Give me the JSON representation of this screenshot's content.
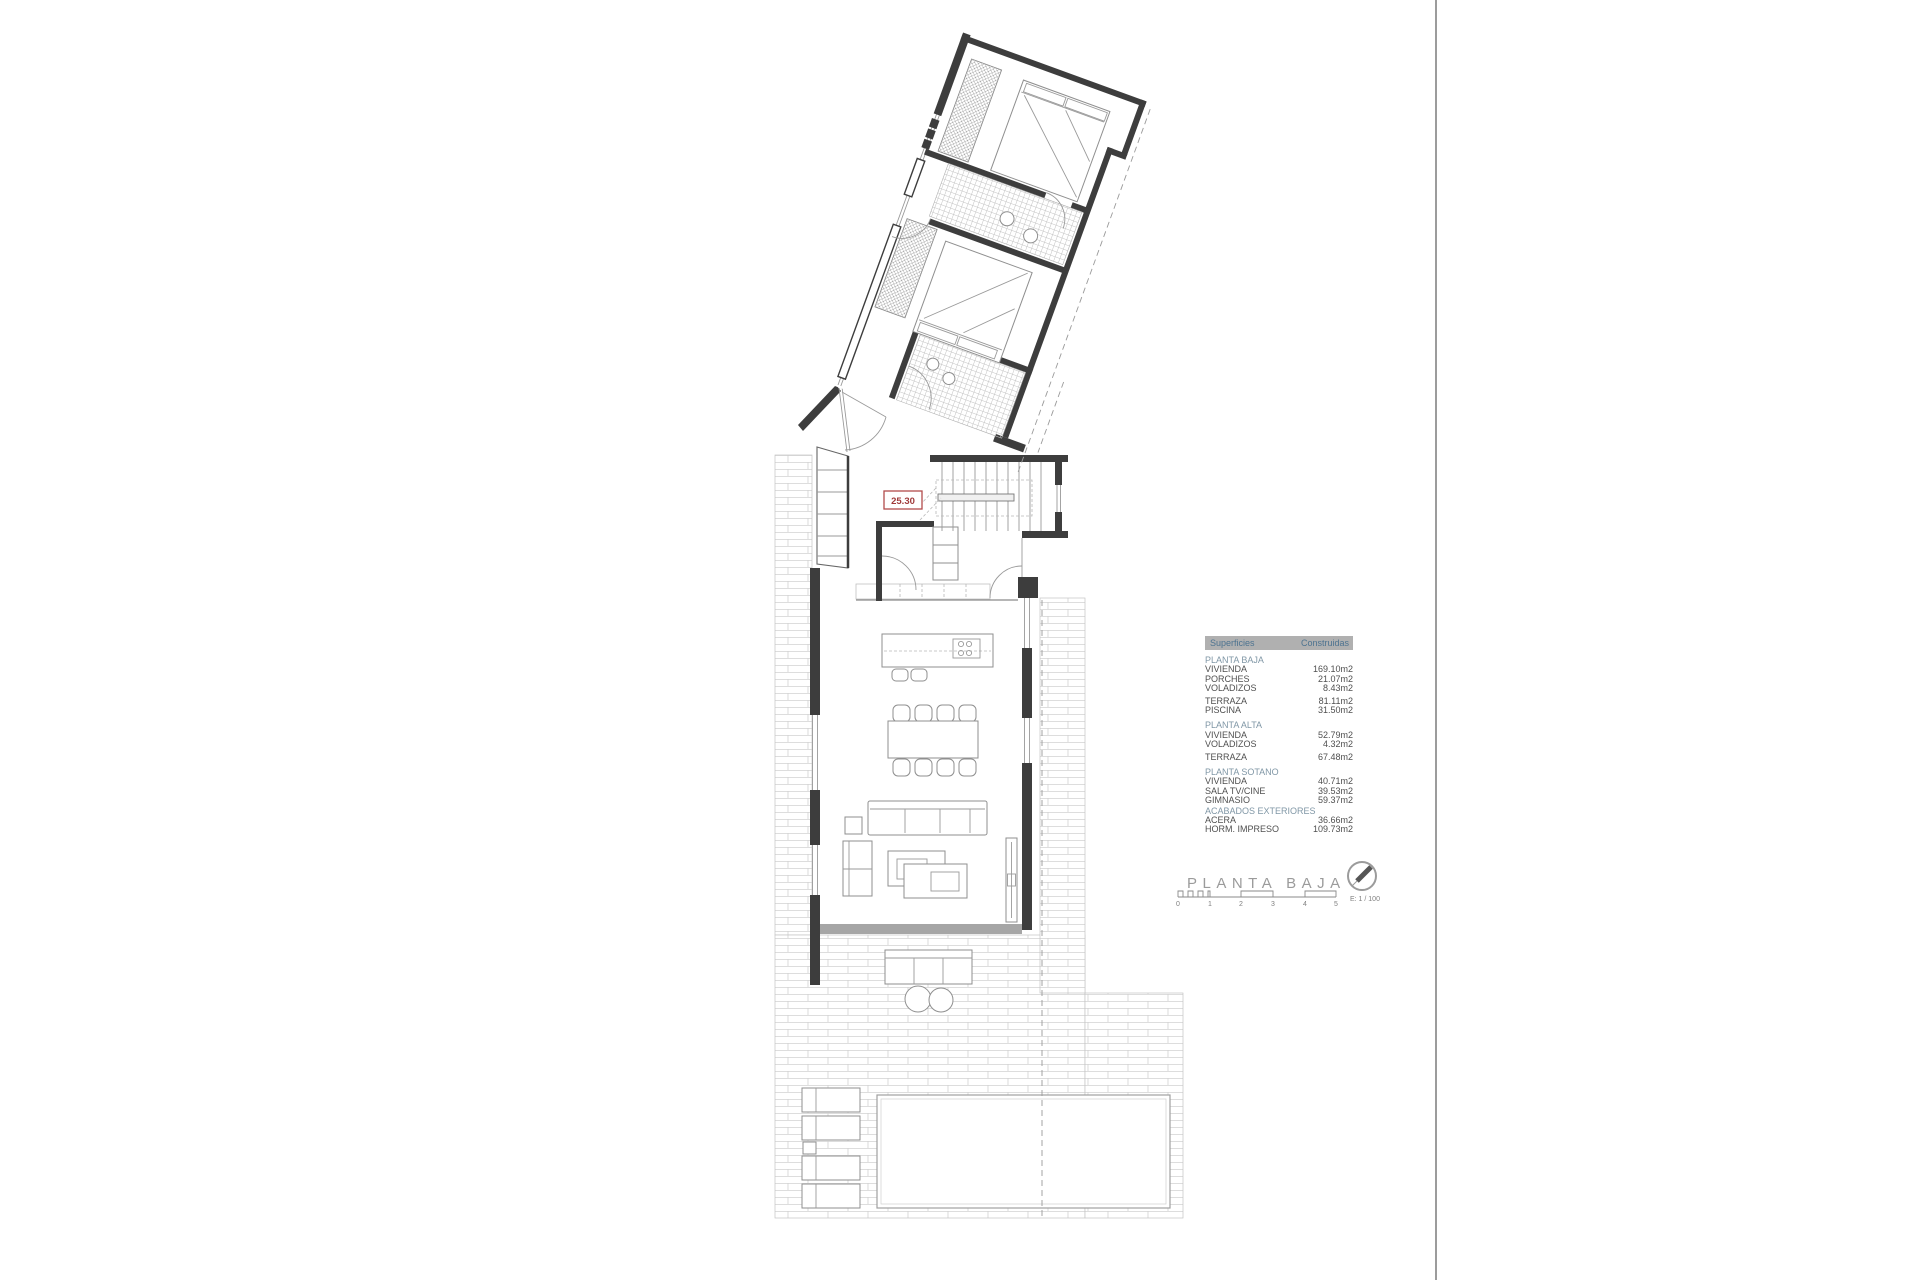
{
  "plan": {
    "dimension_label": "25.30"
  },
  "title_block": {
    "title": "PLANTA BAJA",
    "scale_text": "E: 1 / 100",
    "ticks": [
      "0",
      "1",
      "2",
      "3",
      "4",
      "5"
    ]
  },
  "areas_table": {
    "header": {
      "col1": "Superficies",
      "col2": "Construidas"
    },
    "rows": [
      {
        "type": "section",
        "label": "PLANTA BAJA"
      },
      {
        "type": "item",
        "label": "VIVIENDA",
        "value": "169.10m2"
      },
      {
        "type": "item",
        "label": "PORCHES",
        "value": "21.07m2"
      },
      {
        "type": "item",
        "label": "VOLADIZOS",
        "value": "8.43m2"
      },
      {
        "type": "gap"
      },
      {
        "type": "item",
        "label": "TERRAZA",
        "value": "81.11m2"
      },
      {
        "type": "item",
        "label": "PISCINA",
        "value": "31.50m2"
      },
      {
        "type": "gap"
      },
      {
        "type": "section",
        "label": "PLANTA ALTA"
      },
      {
        "type": "item",
        "label": "VIVIENDA",
        "value": "52.79m2"
      },
      {
        "type": "item",
        "label": "VOLADIZOS",
        "value": "4.32m2"
      },
      {
        "type": "gap"
      },
      {
        "type": "item",
        "label": "TERRAZA",
        "value": "67.48m2"
      },
      {
        "type": "gap"
      },
      {
        "type": "section",
        "label": "PLANTA SOTANO"
      },
      {
        "type": "item",
        "label": "VIVIENDA",
        "value": "40.71m2"
      },
      {
        "type": "item",
        "label": "SALA TV/CINE",
        "value": "39.53m2"
      },
      {
        "type": "item",
        "label": "GIMNASIO",
        "value": "59.37m2"
      },
      {
        "type": "section",
        "label": "ACABADOS EXTERIORES"
      },
      {
        "type": "item",
        "label": "ACERA",
        "value": "36.66m2"
      },
      {
        "type": "item",
        "label": "HORM. IMPRESO",
        "value": "109.73m2"
      }
    ]
  },
  "colors": {
    "dimension_red": "#a03a3a",
    "wall_dark": "#3d3d3d",
    "table_header_bg": "#b0b0b0",
    "table_header_text": "#4d7390",
    "table_section_text": "#8097a6",
    "title_gray": "#9b9b9b"
  }
}
